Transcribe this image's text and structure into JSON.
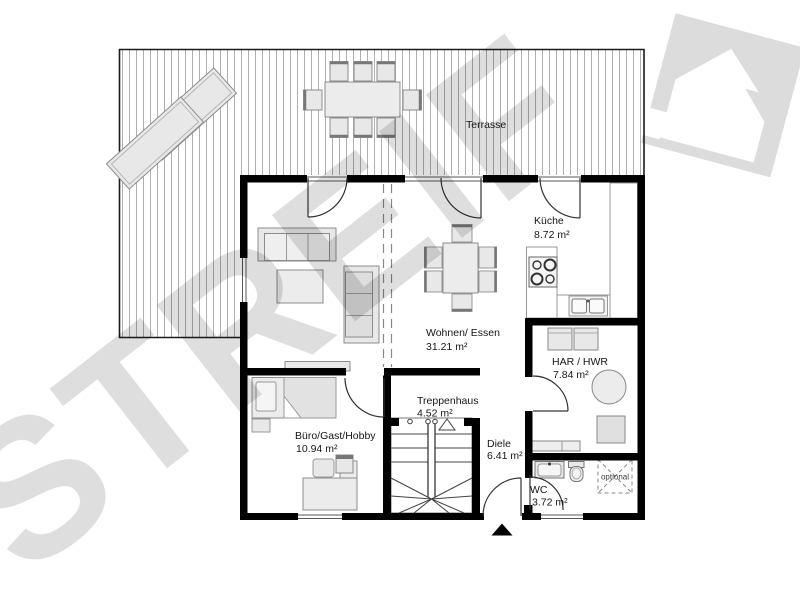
{
  "plan": {
    "title_hint": "ground-floor plan",
    "watermark": "STREIF",
    "brand_logo": "streif-house-logo",
    "terrace": {
      "label": "Terrasse"
    },
    "rooms": [
      {
        "id": "kueche",
        "name": "Küche",
        "area": "8.72 m²"
      },
      {
        "id": "wohnen",
        "name": "Wohnen/ Essen",
        "area": "31.21 m²"
      },
      {
        "id": "har",
        "name": "HAR / HWR",
        "area": "7.84 m²"
      },
      {
        "id": "treppenhaus",
        "name": "Treppenhaus",
        "area": "4.52 m²"
      },
      {
        "id": "diele",
        "name": "Diele",
        "area": "6.41 m²"
      },
      {
        "id": "buero",
        "name": "Büro/Gast/Hobby",
        "area": "10.94 m²"
      },
      {
        "id": "wc",
        "name": "WC",
        "area": "3.72 m²"
      }
    ],
    "optional_label": "optional",
    "icons": {
      "entrance_marker": "up-arrow-triangle",
      "stair_direction": "up-arrow-outline"
    },
    "colors": {
      "wall": "#000000",
      "furniture_fill": "#e8e8e8",
      "furniture_stroke": "#8c8c8c",
      "deck_line": "#a6a6a6",
      "door_stroke": "#333333",
      "watermark": "#dedede"
    }
  }
}
